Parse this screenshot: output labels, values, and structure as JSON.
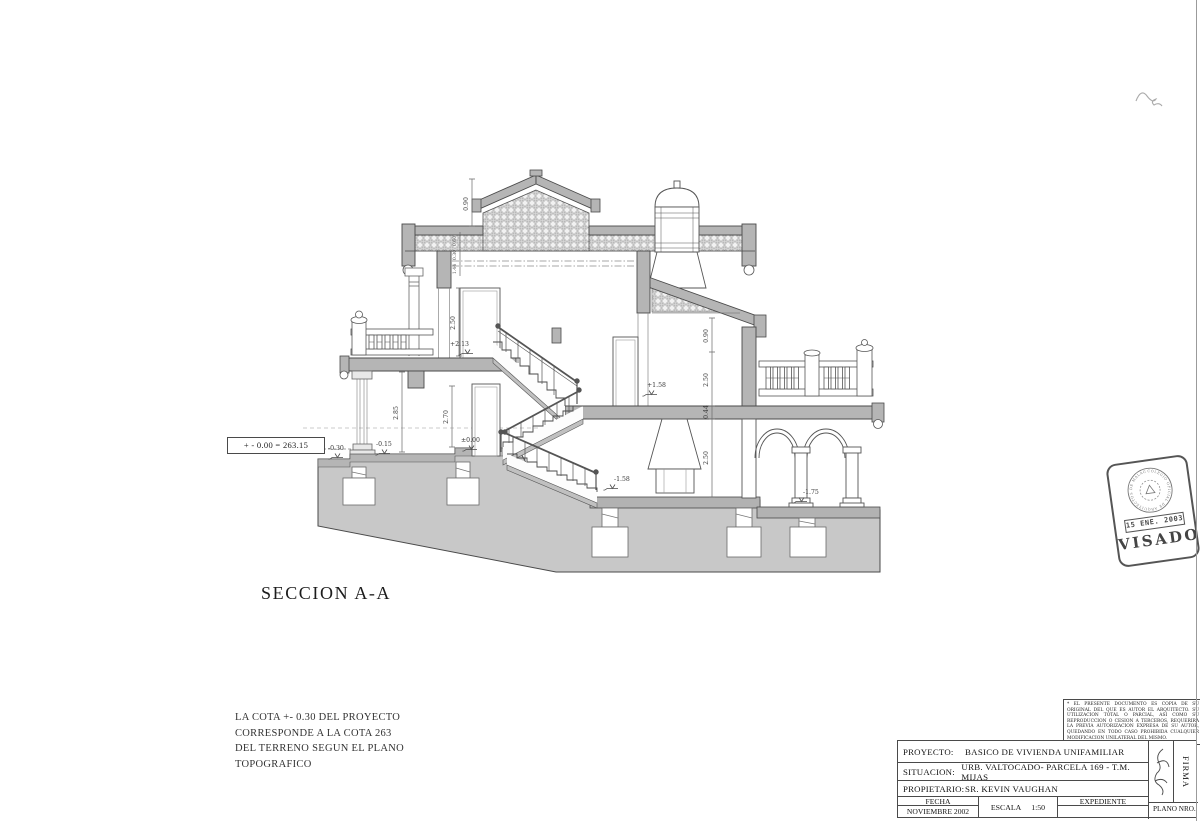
{
  "page": {
    "background": "#ffffff",
    "ink": "#444444",
    "wall_fill": "#b5b5b5",
    "ground_fill": "#c8c8c8"
  },
  "drawing": {
    "section_title": "SECCION A-A",
    "datum_box": "+ - 0.00 = 263.15",
    "levels": {
      "upper_floor": "+2.13",
      "terrace": "+1.58",
      "ground": "±0.00",
      "entry_mid": "-0.15",
      "entry_low": "-0.30",
      "basement": "-1.58",
      "porch": "-1.75"
    },
    "dims": {
      "gable": "0.90",
      "eave_a": "0.60",
      "eave_b": "0.30",
      "eave_c": "1.44",
      "upper_room": "2.50",
      "left_column": "2.85",
      "lower_left": "2.70",
      "right_top": "0.90",
      "right_room": "2.50",
      "slab": "0.44",
      "lower_right": "2.50"
    }
  },
  "footnote": {
    "line1": "LA COTA +- 0.30 DEL PROYECTO",
    "line2": "CORRESPONDE A LA COTA 263",
    "line3": "DEL TERRENO SEGUN EL PLANO",
    "line4": "TOPOGRAFICO"
  },
  "disclaimer": {
    "text": "* EL PRESENTE DOCUMENTO ES COPIA DE SU ORIGINAL DEL QUE ES AUTOR EL ARQUITECTO. SU UTILIZACION TOTAL O PARCIAL, ASI COMO SU REPRODUCCION O CESION A TERCEROS, REQUERIRA LA PREVIA AUTORIZACION EXPRESA DE SU AUTOR, QUEDANDO EN TODO CASO PROHIBIDA CUALQUIER MODIFICACION UNILATERAL DEL MISMO."
  },
  "stamp": {
    "visado": "VISADO",
    "date": "15 ENE. 2003",
    "seal_text": "COLEGIO OFICIAL DE ARQUITECTOS DE MALAGA"
  },
  "titleblock": {
    "proyecto_label": "PROYECTO:",
    "proyecto_value": "BASICO DE VIVIENDA UNIFAMILIAR",
    "situacion_label": "SITUACION:",
    "situacion_value": "URB. VALTOCADO- PARCELA 169 - T.M. MIJAS",
    "propietario_label": "PROPIETARIO:",
    "propietario_value": "SR. KEVIN VAUGHAN",
    "fecha_label": "FECHA",
    "fecha_value": "NOVIEMBRE 2002",
    "escala_label": "ESCALA",
    "escala_value": "1:50",
    "expediente_label": "EXPEDIENTE",
    "plano_label": "PLANO NRO.",
    "firma_label": "FIRMA"
  }
}
